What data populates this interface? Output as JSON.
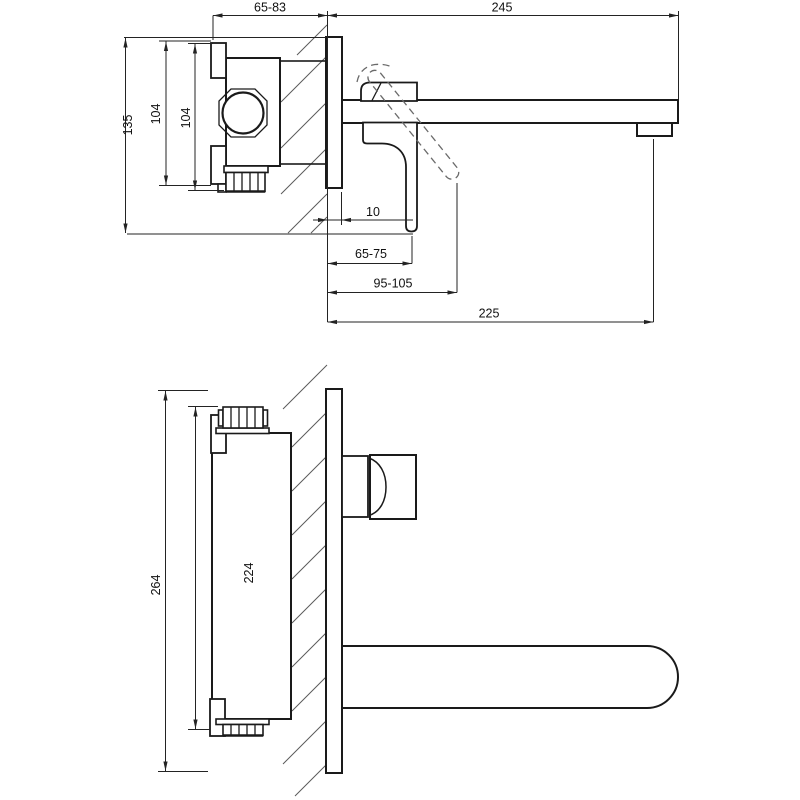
{
  "drawing": {
    "kind": "technical-dimension-drawing",
    "subject": "wall-mounted-single-lever-basin-mixer",
    "line_color": "#1a1a1a",
    "background": "#ffffff",
    "side_view": {
      "dims": {
        "body_depth_adjust": "65-83",
        "spout_length": "245",
        "height_total": "135",
        "body_height_outer": "104",
        "body_height_inner": "104",
        "plate_offset": "10",
        "handle_projection_min": "65-75",
        "handle_projection_max": "95-105",
        "spout_projection": "225"
      }
    },
    "plan_view": {
      "dims": {
        "plate_length": "264",
        "body_length": "224"
      }
    }
  }
}
